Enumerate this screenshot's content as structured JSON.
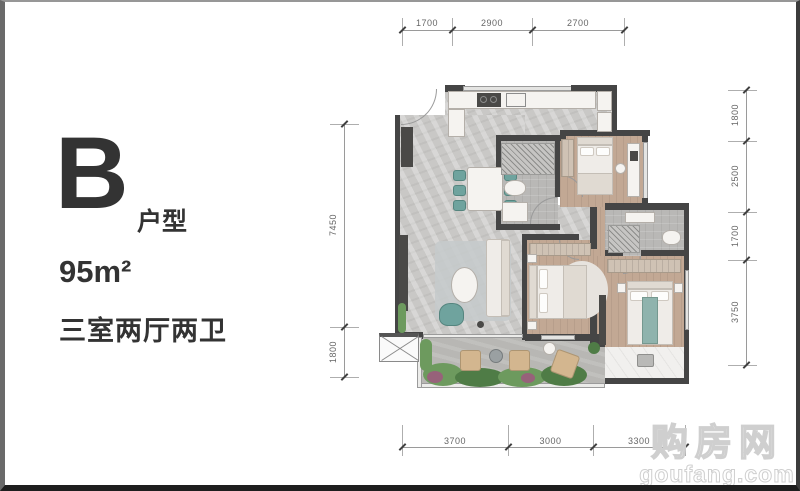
{
  "panel": {
    "letter": "B",
    "letter_suffix": "户型",
    "area": "95m²",
    "rooms": "三室两厅两卫"
  },
  "dims": {
    "top": [
      "1700",
      "2900",
      "2700"
    ],
    "right": [
      "1800",
      "2500",
      "1700",
      "3750"
    ],
    "left": [
      "7450",
      "1800"
    ],
    "bottom": [
      "3700",
      "3000",
      "3300"
    ]
  },
  "watermark": {
    "cn": "购房网",
    "en": "goufang.com"
  },
  "colors": {
    "wall": "#454545",
    "marble_floor": "#c9c8c6",
    "wood_floor": "#c2a894",
    "accent_teal": "#6fa39e",
    "plant_green": "#6d9a5e",
    "outdoor_tan": "#d3b68f",
    "frame_dark": "#1e1e1e"
  }
}
